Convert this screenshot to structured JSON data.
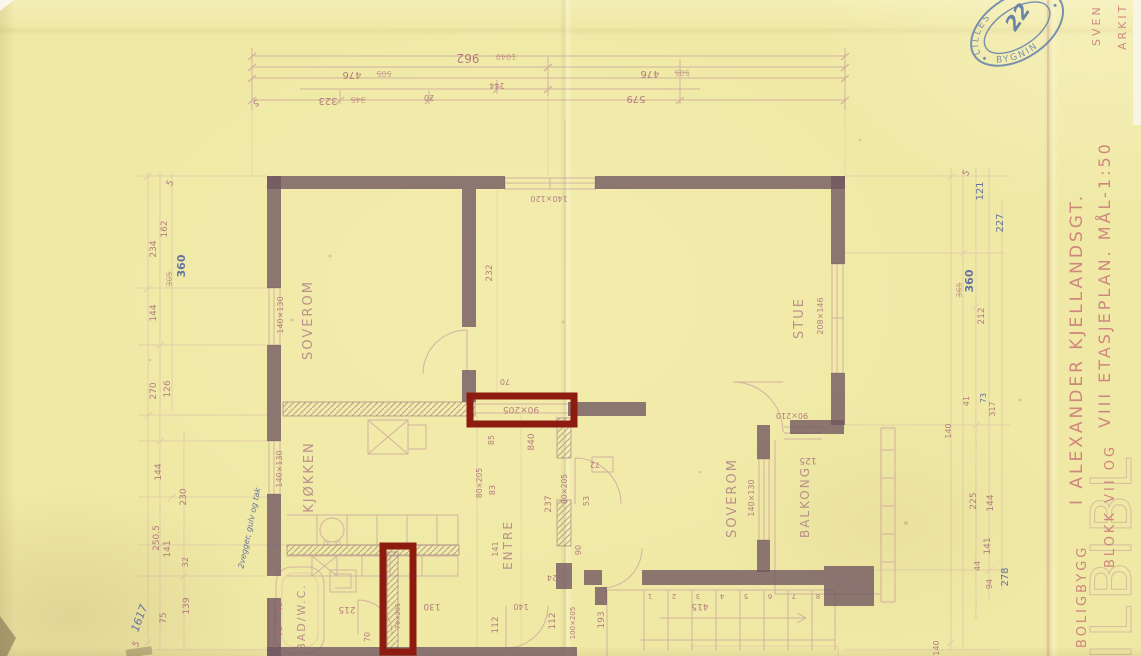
{
  "stamp": {
    "top": "LILLES",
    "bottom": "BYGNIN",
    "note": "22"
  },
  "margin": {
    "l1_small": "BOLIGBYGG",
    "l1_main": "I ALEXANDER KJELLANDSGT.",
    "l2_small": "BLOKK VII OG",
    "l2_main": "VIII ETASJEPLAN. MÅL-1:50",
    "side_a": "SVEN",
    "side_b": "ARKIT",
    "watermark": "ILBIBL"
  },
  "rooms": {
    "soverom1": "SOVEROM",
    "stue": "STUE",
    "kjokken": "KJØKKEN",
    "entre": "ENTRE",
    "soverom2": "SOVEROM",
    "balkong": "BALKONG",
    "bad": "BAD/W.C."
  },
  "windows": {
    "soverom1": "140×130",
    "top_mid": "140×120",
    "stue": "208×146",
    "kjokken": "140×130",
    "soverom2": "140×130"
  },
  "doors": {
    "entre_kjokken": "80×205",
    "entre_soverom2": "80×205",
    "highlight": "90×205",
    "balkong": "90×210",
    "trapp": "100×205",
    "bad": "70×205"
  },
  "dims_top": {
    "overall": "962",
    "overall_struck": "1040",
    "left": "476",
    "left_struck": "505",
    "right": "476",
    "right_struck": "505",
    "mid": "144",
    "d579": "579",
    "d20": "20",
    "d323": "323",
    "d323_struck": "345",
    "d5": "5"
  },
  "dims_left": {
    "d5a": "5",
    "d234": "234",
    "d162": "162",
    "d360": "360",
    "d360_struck": "305",
    "d144a": "144",
    "d270": "270",
    "d126": "126",
    "d144b": "144",
    "d230": "230",
    "d2505": "250.5",
    "d141": "141",
    "d32": "32",
    "d139": "139",
    "d75": "75",
    "d1617": "1617",
    "d5b": "5"
  },
  "dims_right": {
    "d5": "5",
    "d121": "121",
    "d227": "227",
    "d360": "360",
    "d360_struck": "365",
    "d212": "212",
    "d41": "41",
    "d73": "73",
    "d317": "317",
    "d140a": "140",
    "d225": "225",
    "d144": "144",
    "d141": "141",
    "d44": "44",
    "d94": "94",
    "d278": "278",
    "d140b": "140"
  },
  "dims_inner": {
    "d232": "232",
    "d840": "840",
    "d237": "237",
    "d83": "83",
    "d85": "85",
    "d70a": "70",
    "d53": "53",
    "d90": "90",
    "d72": "72",
    "d141": "141",
    "d112a": "112",
    "d112b": "112",
    "d140": "140",
    "d24": "24",
    "d215": "215",
    "d70b": "70",
    "d72b": "72",
    "d40": "40",
    "d130": "130",
    "d193": "193",
    "d415": "415",
    "d125": "125"
  },
  "stairs": [
    "1",
    "2",
    "3",
    "4",
    "5",
    "6",
    "7",
    "8"
  ],
  "notes": {
    "pencil": "2vegger, gulv og tak"
  },
  "colors": {
    "paper": "#f0e9a6",
    "ink": "#b5717c",
    "pencil": "#56679b",
    "wall": "#6f5560",
    "highlight": "#8e1b10",
    "stamp": "#5b79ab"
  }
}
